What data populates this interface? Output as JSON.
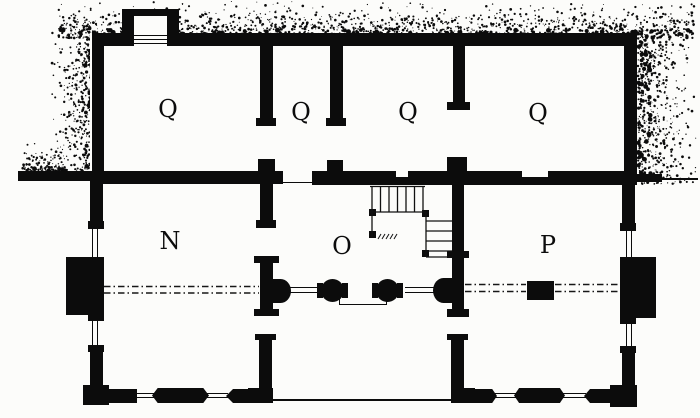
{
  "drawing": {
    "type_label": "floor-plan"
  },
  "colors": {
    "ink": "#0c0c0c",
    "paper": "#fcfcfa"
  },
  "rooms": {
    "q1": "Q",
    "q2": "Q",
    "q3": "Q",
    "q4": "Q",
    "n": "N",
    "o": "O",
    "p": "P"
  }
}
